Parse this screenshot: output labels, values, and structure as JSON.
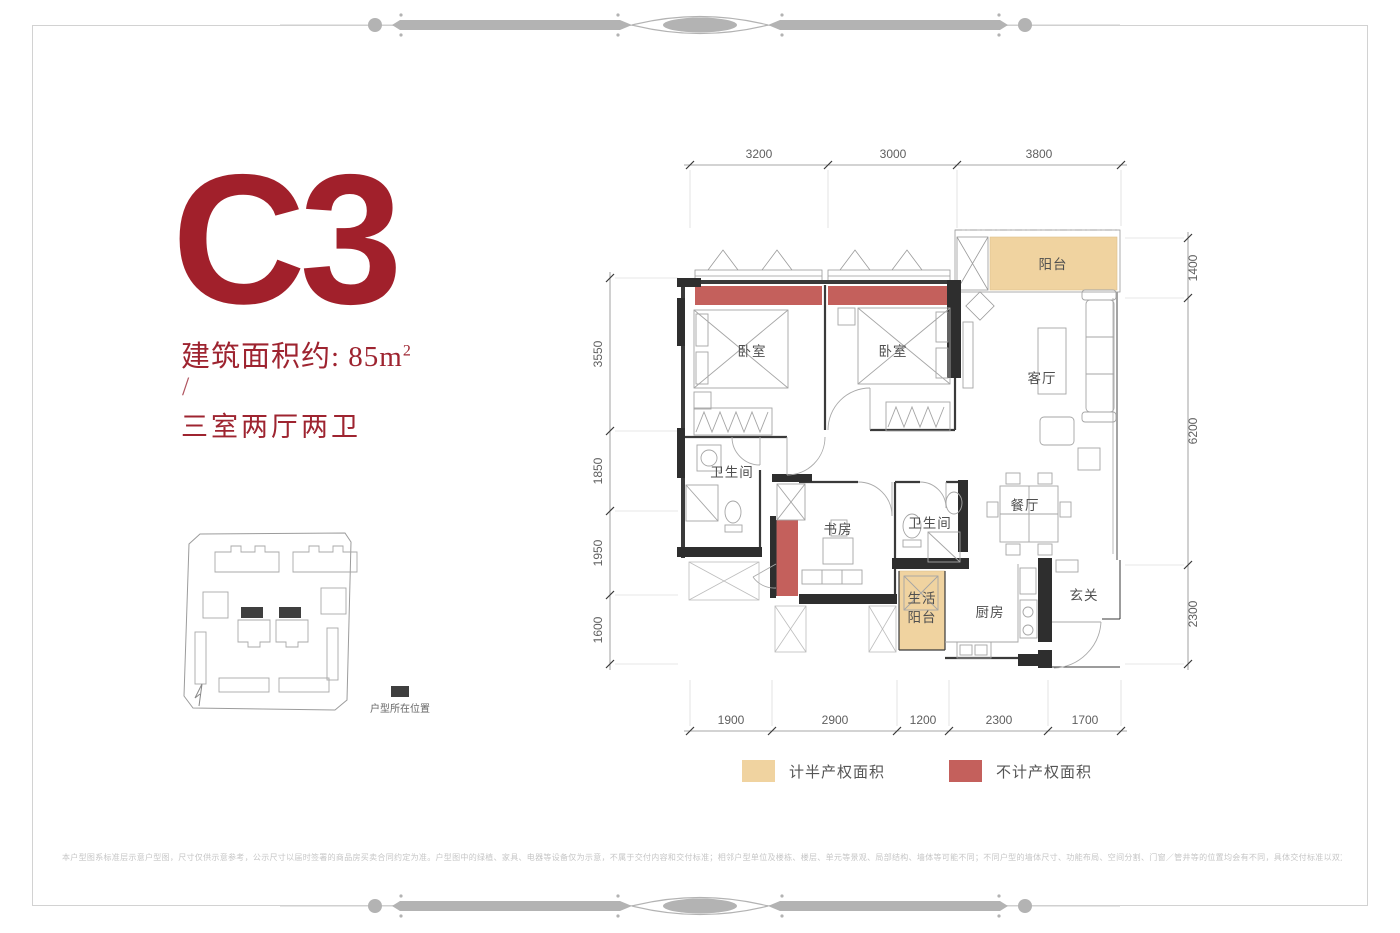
{
  "header": {
    "unit_code": "C3",
    "area_prefix": "建筑面积约: 85m",
    "area_sup": "2",
    "separator": "/",
    "layout": "三室两厅两卫"
  },
  "site_plan": {
    "marker_label": "户型所在位置"
  },
  "floorplan": {
    "dimensions": {
      "top": [
        "3200",
        "3000",
        "3800"
      ],
      "bottom": [
        "1900",
        "2900",
        "1200",
        "2300",
        "1700"
      ],
      "left": [
        "3550",
        "1850",
        "1950",
        "1600"
      ],
      "right": [
        "1400",
        "6200",
        "2300"
      ]
    },
    "rooms": [
      {
        "name": "阳台"
      },
      {
        "name": "卧室"
      },
      {
        "name": "卧室"
      },
      {
        "name": "客厅"
      },
      {
        "name": "卫生间"
      },
      {
        "name": "书房"
      },
      {
        "name": "卫生间"
      },
      {
        "name": "餐厅"
      },
      {
        "name": "生活阳台",
        "line1": "生活",
        "line2": "阳台"
      },
      {
        "name": "厨房"
      },
      {
        "name": "玄关"
      }
    ]
  },
  "legend": {
    "half_property": "计半产权面积",
    "no_property": "不计产权面积"
  },
  "colors": {
    "accent_red": "#9e2430",
    "bay_red": "#c4605c",
    "balcony_orange": "#f0d3a0",
    "wall_black": "#2e2e2e",
    "marker_dark": "#3f3f3f"
  },
  "footer": {
    "disclaimer": "本户型图系标准层示意户型图，尺寸仅供示意参考，公示尺寸以届时签署的商品房买卖合同约定为准。户型图中的绿植、家具、电器等设备仅为示意，不属于交付内容和交付标准；相邻户型单位及楼栋、楼层、单元等景观、局部结构、墙体等可能不同；不同户型的墙体尺寸、功能布局、空间分割、门窗／管井等的位置均会有不同，具体交付标准以双方签订的《商品房买卖合同》及其附件约定为准；广告所示内容非要约，敬请留意。本资料印刷时间为2021年11月，本公司保留对该内容修改的权利，敬请留意最新资料。"
  }
}
